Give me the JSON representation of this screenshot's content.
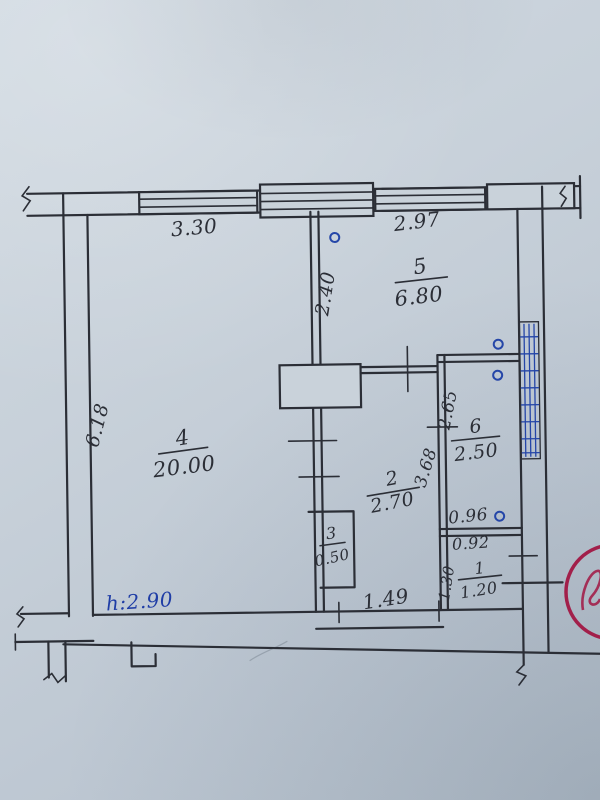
{
  "plan": {
    "rooms": [
      {
        "number": "5",
        "area": "6.80"
      },
      {
        "number": "4",
        "area": "20.00"
      },
      {
        "number": "6",
        "area": "2.50"
      },
      {
        "number": "2",
        "area": "2.70"
      },
      {
        "number": "3",
        "area": "0.50"
      },
      {
        "number": "1",
        "area": "1.20"
      }
    ],
    "dims": {
      "window_left": "3.30",
      "window_right": "2.97",
      "room5_depth": "2.40",
      "left_side": "6.18",
      "room6_depth": "2.65",
      "hallway_depth": "3.68",
      "room6_width": "0.96",
      "bathroom_width": "0.92",
      "bathroom_depth": "1.30",
      "hallway_width": "1.49"
    },
    "height_mark": "h:2.90",
    "colors": {
      "ink": "#2b2e36",
      "annotation_blue": "#2546a8",
      "stamp_red": "#a21f4a",
      "paper": "#c8d1da"
    }
  }
}
